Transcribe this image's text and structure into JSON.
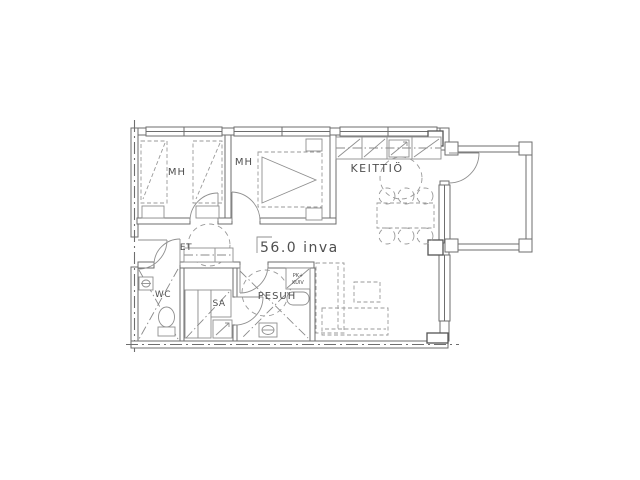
{
  "floorplan": {
    "area_label": "56.0 inva",
    "rooms": {
      "bedroom_1": {
        "label": "MH"
      },
      "bedroom_2": {
        "label": "MH"
      },
      "kitchen": {
        "label": "KEITTIÖ"
      },
      "hallway": {
        "label": "ET"
      },
      "wc": {
        "label": "WC"
      },
      "sauna": {
        "label": "SA"
      },
      "washroom": {
        "label": "PESUH"
      }
    },
    "laundry_unit": {
      "line1": "PK+",
      "line2": "KUIV"
    },
    "colors": {
      "background": "#ffffff",
      "wall_line": "#6e6e6e",
      "furniture_line": "#8f8f8f",
      "dashed_line": "#9a9a9a",
      "text": "#4f4f4f"
    }
  }
}
